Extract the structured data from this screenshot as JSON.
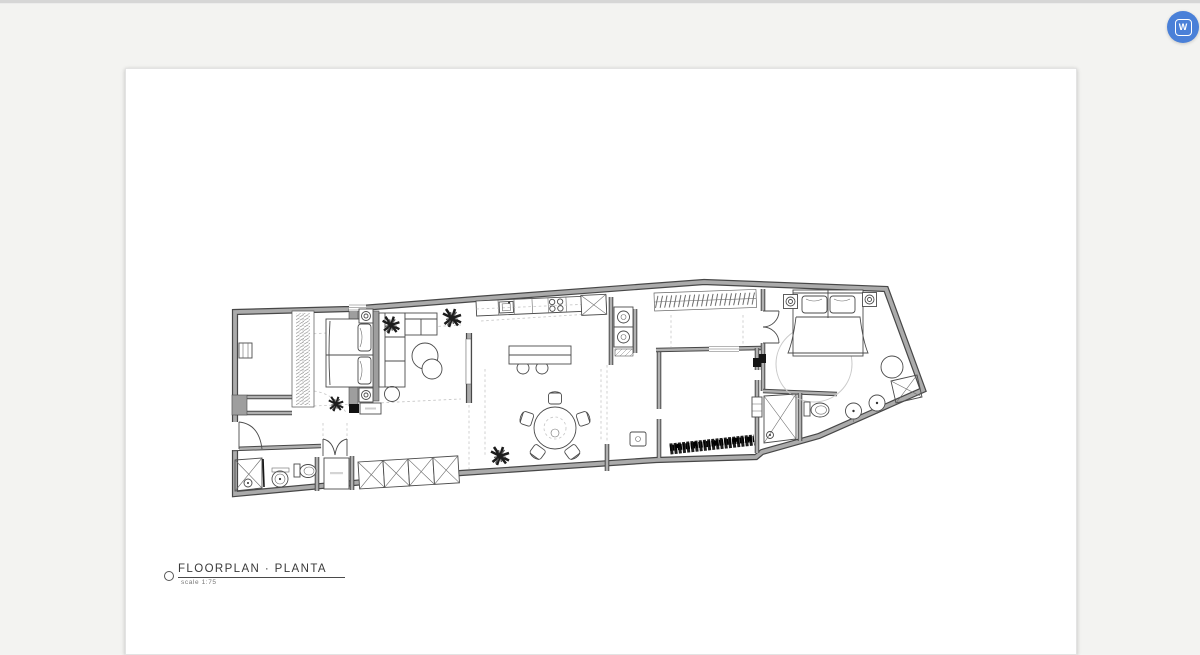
{
  "canvas": {
    "bg": "#f3f3f1",
    "topbar_color": "#d6d6d6"
  },
  "badge": {
    "letter": "W",
    "bg": "#4a80d8"
  },
  "sheet": {
    "title": "FLOORPLAN · PLANTA",
    "scale": "scale 1:75",
    "bg": "#ffffff"
  },
  "plan": {
    "wall_fill": "#ababab",
    "wall_edge": "#474747",
    "furniture_line": "#4b4b4b",
    "ceiling_dash": "#c6c6c6",
    "plant_color": "#1c1c1c",
    "rug_line": "#c9c9c9"
  }
}
